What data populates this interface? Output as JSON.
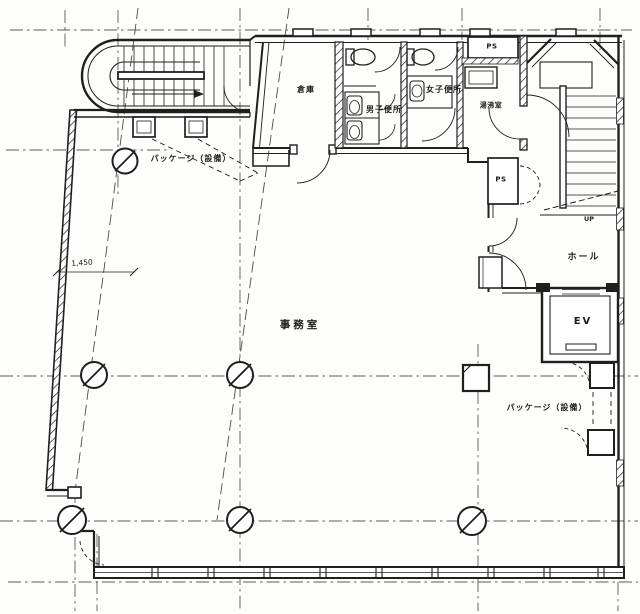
{
  "drawing": {
    "kind": "architectural floor plan (scanned)",
    "colors": {
      "ink": "#1f1f1f",
      "paper": "#fdfdfb",
      "grid": "#5a5a5a"
    }
  },
  "labels": {
    "package_top": "パッケージ（設備）",
    "storage": "倉庫",
    "mens_toilet": "男子便所",
    "womens_toilet": "女子便所",
    "kitchenette": "湯沸室",
    "ps_top": "PS",
    "ps_mid": "PS",
    "hall": "ホール",
    "up": "UP",
    "office": "事務室",
    "elevator": "EV",
    "package_bottom": "パッケージ（設備）",
    "dimension_left": "1,450"
  }
}
